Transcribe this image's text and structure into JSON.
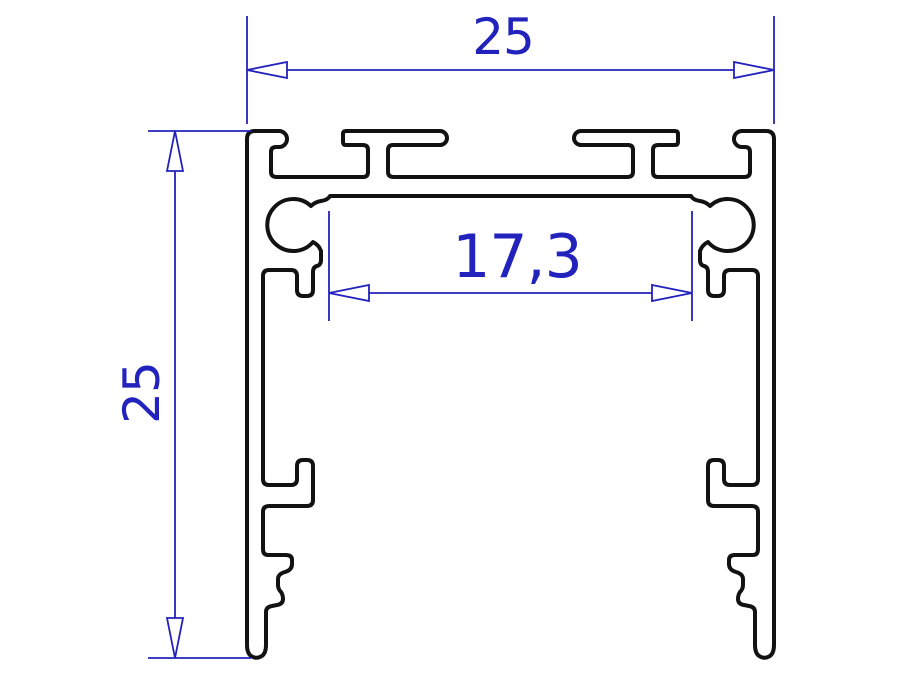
{
  "colors": {
    "outline": "#121212",
    "dimension": "#2222bd",
    "background": "#ffffff",
    "arrow_fill": "#ffffff"
  },
  "dimensions": {
    "overall_width": {
      "value": "25"
    },
    "overall_height": {
      "value": "25"
    },
    "inner_width": {
      "value": "17,3"
    }
  }
}
